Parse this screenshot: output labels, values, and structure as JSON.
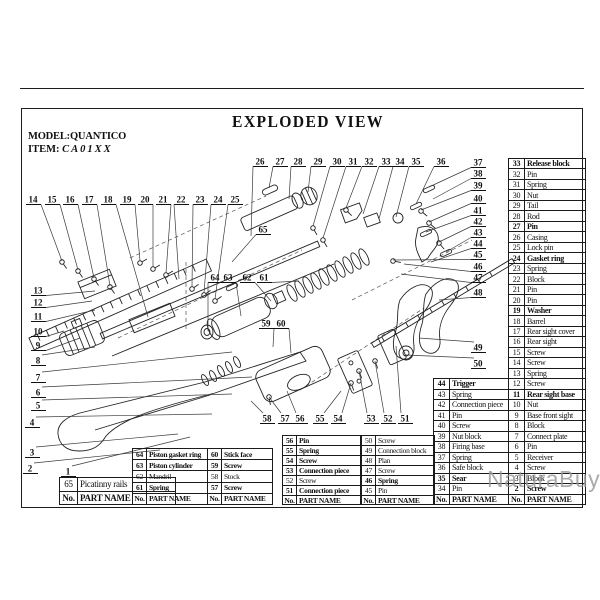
{
  "page": {
    "title": "EXPLODED VIEW",
    "model": "MODEL:QUANTICO",
    "item_label": "ITEM:",
    "item_value": "CA01XX",
    "watermark": "NaturaBuy"
  },
  "tables": {
    "col_no": "No.",
    "col_name": "PART NAME",
    "right": {
      "rows": [
        [
          33,
          "Release block",
          1
        ],
        [
          32,
          "Pin",
          0
        ],
        [
          31,
          "Spring",
          0
        ],
        [
          30,
          "Nut",
          0
        ],
        [
          29,
          "Tail",
          0
        ],
        [
          28,
          "Rod",
          0
        ],
        [
          27,
          "Pin",
          1
        ],
        [
          26,
          "Casing",
          0
        ],
        [
          25,
          "Lock pin",
          0
        ],
        [
          24,
          "Gasket ring",
          1
        ],
        [
          23,
          "Spring",
          0
        ],
        [
          22,
          "Block",
          0
        ],
        [
          21,
          "Pin",
          0
        ],
        [
          20,
          "Pin",
          0
        ],
        [
          19,
          "Washer",
          1
        ],
        [
          18,
          "Barrel",
          0
        ],
        [
          17,
          "Rear sight cover",
          0
        ],
        [
          16,
          "Rear sight",
          0
        ],
        [
          15,
          "Screw",
          0
        ],
        [
          14,
          "Screw",
          0
        ],
        [
          13,
          "Spring",
          0
        ],
        [
          12,
          "Screw",
          0
        ],
        [
          11,
          "Rear sight base",
          1
        ],
        [
          10,
          "Nut",
          0
        ],
        [
          9,
          "Base front sight",
          0
        ],
        [
          8,
          "Block",
          0
        ],
        [
          7,
          "Connect plate",
          0
        ],
        [
          6,
          "Pin",
          0
        ],
        [
          5,
          "Receiver",
          0
        ],
        [
          4,
          "Screw",
          0
        ],
        [
          3,
          "Block",
          0
        ],
        [
          2,
          "Screw",
          1
        ]
      ]
    },
    "mid": {
      "rows": [
        [
          44,
          "Trigger",
          1
        ],
        [
          43,
          "Spring",
          0
        ],
        [
          42,
          "Connection piece",
          0
        ],
        [
          41,
          "Pin",
          0
        ],
        [
          40,
          "Screw",
          0
        ],
        [
          39,
          "Nut block",
          0
        ],
        [
          38,
          "Firing base",
          0
        ],
        [
          37,
          "Spring",
          0
        ],
        [
          36,
          "Safe block",
          0
        ],
        [
          35,
          "Sear",
          1
        ],
        [
          34,
          "Pin",
          0
        ]
      ]
    },
    "e": {
      "rows": [
        [
          50,
          "Screw",
          0
        ],
        [
          49,
          "Connection block",
          0
        ],
        [
          48,
          "Plan",
          0
        ],
        [
          47,
          "Screw",
          0
        ],
        [
          46,
          "Spring",
          1
        ],
        [
          45,
          "Pin",
          0
        ]
      ]
    },
    "d": {
      "rows": [
        [
          56,
          "Pin",
          1
        ],
        [
          55,
          "Spring",
          1
        ],
        [
          54,
          "Screw",
          1
        ],
        [
          53,
          "Connection piece",
          1
        ],
        [
          52,
          "Screw",
          0
        ],
        [
          51,
          "Connection piece",
          1
        ]
      ]
    },
    "c": {
      "rows": [
        [
          60,
          "Stick face",
          1
        ],
        [
          59,
          "Screw",
          1
        ],
        [
          58,
          "Stock",
          0
        ],
        [
          57,
          "Screw",
          1
        ]
      ]
    },
    "b": {
      "rows": [
        [
          64,
          "Piston gasket ring",
          1
        ],
        [
          63,
          "Piston cylinder",
          1
        ],
        [
          62,
          "Mandril",
          0
        ],
        [
          61,
          "Spring",
          1
        ]
      ]
    },
    "a": {
      "rows": [
        [
          65,
          "Picatinny rails",
          0
        ]
      ]
    }
  },
  "callouts": [
    [
      1,
      68,
      472,
      190,
      437
    ],
    [
      2,
      30,
      469,
      160,
      450
    ],
    [
      3,
      32,
      453,
      178,
      434
    ],
    [
      4,
      32,
      423,
      212,
      414
    ],
    [
      5,
      38,
      406,
      232,
      394
    ],
    [
      6,
      38,
      393,
      252,
      377
    ],
    [
      7,
      38,
      378,
      232,
      352
    ],
    [
      8,
      38,
      361,
      95,
      347
    ],
    [
      9,
      38,
      346,
      80,
      338
    ],
    [
      10,
      38,
      332,
      64,
      331
    ],
    [
      11,
      38,
      317,
      95,
      310
    ],
    [
      12,
      38,
      303,
      92,
      301
    ],
    [
      13,
      38,
      291,
      95,
      291
    ],
    [
      14,
      33,
      200,
      62,
      261
    ],
    [
      15,
      52,
      200,
      78,
      270
    ],
    [
      16,
      70,
      200,
      94,
      278
    ],
    [
      17,
      89,
      200,
      110,
      286
    ],
    [
      18,
      108,
      200,
      148,
      317
    ],
    [
      19,
      127,
      200,
      140,
      261
    ],
    [
      20,
      145,
      200,
      153,
      267
    ],
    [
      21,
      163,
      200,
      166,
      273
    ],
    [
      22,
      181,
      200,
      179,
      279
    ],
    [
      23,
      200,
      200,
      192,
      287
    ],
    [
      24,
      218,
      200,
      204,
      293
    ],
    [
      25,
      235,
      200,
      215,
      299
    ],
    [
      26,
      260,
      162,
      251,
      236
    ],
    [
      27,
      280,
      162,
      269,
      188
    ],
    [
      28,
      298,
      162,
      289,
      199
    ],
    [
      29,
      318,
      162,
      308,
      192
    ],
    [
      30,
      337,
      162,
      313,
      226
    ],
    [
      31,
      353,
      162,
      323,
      238
    ],
    [
      32,
      369,
      162,
      346,
      208
    ],
    [
      33,
      386,
      162,
      363,
      214
    ],
    [
      34,
      400,
      162,
      379,
      219
    ],
    [
      35,
      416,
      162,
      396,
      217
    ],
    [
      36,
      441,
      162,
      416,
      204
    ],
    [
      37,
      478,
      163,
      429,
      187
    ],
    [
      38,
      478,
      174,
      433,
      199
    ],
    [
      39,
      478,
      186,
      421,
      210
    ],
    [
      40,
      478,
      199,
      429,
      222
    ],
    [
      41,
      478,
      211,
      426,
      232
    ],
    [
      42,
      478,
      222,
      439,
      242
    ],
    [
      43,
      478,
      233,
      446,
      252
    ],
    [
      44,
      478,
      244,
      431,
      262
    ],
    [
      45,
      478,
      255,
      393,
      260
    ],
    [
      46,
      478,
      267,
      404,
      264
    ],
    [
      47,
      478,
      278,
      401,
      274
    ],
    [
      48,
      478,
      293,
      439,
      300
    ],
    [
      49,
      478,
      348,
      419,
      338
    ],
    [
      50,
      478,
      364,
      406,
      355
    ],
    [
      51,
      405,
      419,
      396,
      346
    ],
    [
      52,
      388,
      419,
      375,
      361
    ],
    [
      53,
      371,
      419,
      359,
      371
    ],
    [
      54,
      338,
      419,
      351,
      383
    ],
    [
      55,
      320,
      419,
      341,
      391
    ],
    [
      56,
      300,
      419,
      287,
      391
    ],
    [
      57,
      285,
      419,
      269,
      397
    ],
    [
      58,
      267,
      419,
      251,
      401
    ],
    [
      59,
      266,
      324,
      273,
      347
    ],
    [
      60,
      281,
      324,
      291,
      353
    ],
    [
      61,
      264,
      278,
      299,
      281
    ],
    [
      62,
      247,
      278,
      271,
      301
    ],
    [
      63,
      228,
      278,
      241,
      316
    ],
    [
      64,
      215,
      278,
      208,
      331
    ],
    [
      65,
      263,
      230,
      232,
      262
    ]
  ]
}
